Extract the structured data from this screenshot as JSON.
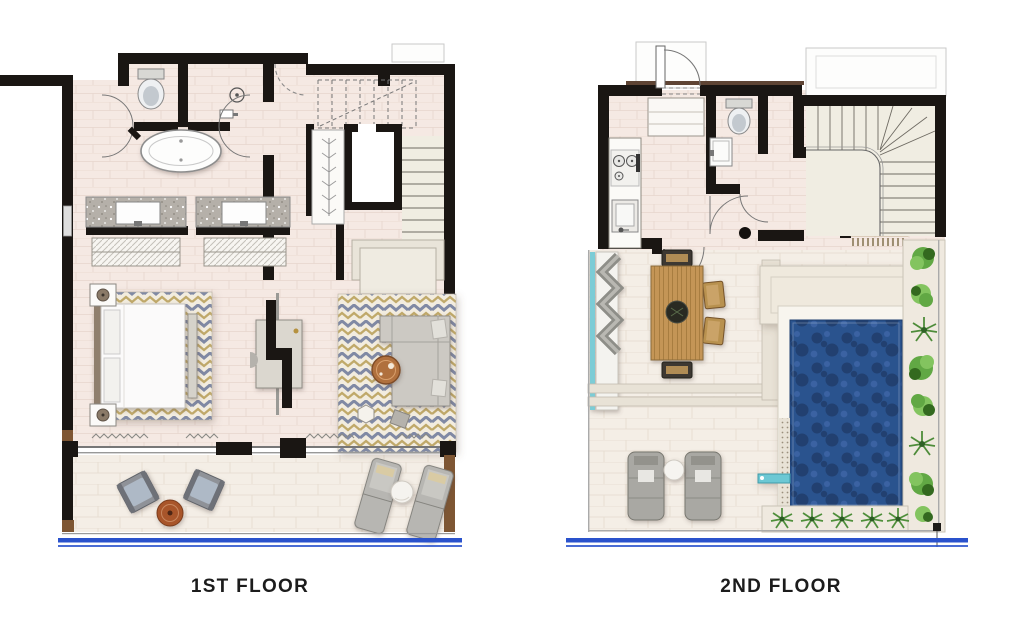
{
  "floors": [
    {
      "label": "1ST FLOOR"
    },
    {
      "label": "2ND FLOOR"
    }
  ],
  "colors": {
    "wall": "#1a1613",
    "floor": "#f5e9e3",
    "floor_line": "#e7d6cd",
    "deck": "#f4eee6",
    "deck_line": "#e4dace",
    "water": "#2c528e",
    "water_dark": "#21406f",
    "water_light": "#3a62a2",
    "plant": "#61a844",
    "plant_dark": "#33691f",
    "plant_light": "#83c45f",
    "wood": "#c49557",
    "wood_line": "#a87d3f",
    "post": "#7e5633",
    "rug_base": "#f2ecdf",
    "rug_blue": "#8089a4",
    "rug_gold": "#c0a96a",
    "teal": "#7cccd6",
    "balustrade": "#2a52cc",
    "gray_f": "#a9a8a3",
    "stair": "#f0ede2",
    "counter": "#b5b0a9",
    "tan": "#d9c7a5",
    "tan_dot": "#b39c74",
    "label": "#1c1c1c",
    "page_bg": "#ffffff"
  }
}
